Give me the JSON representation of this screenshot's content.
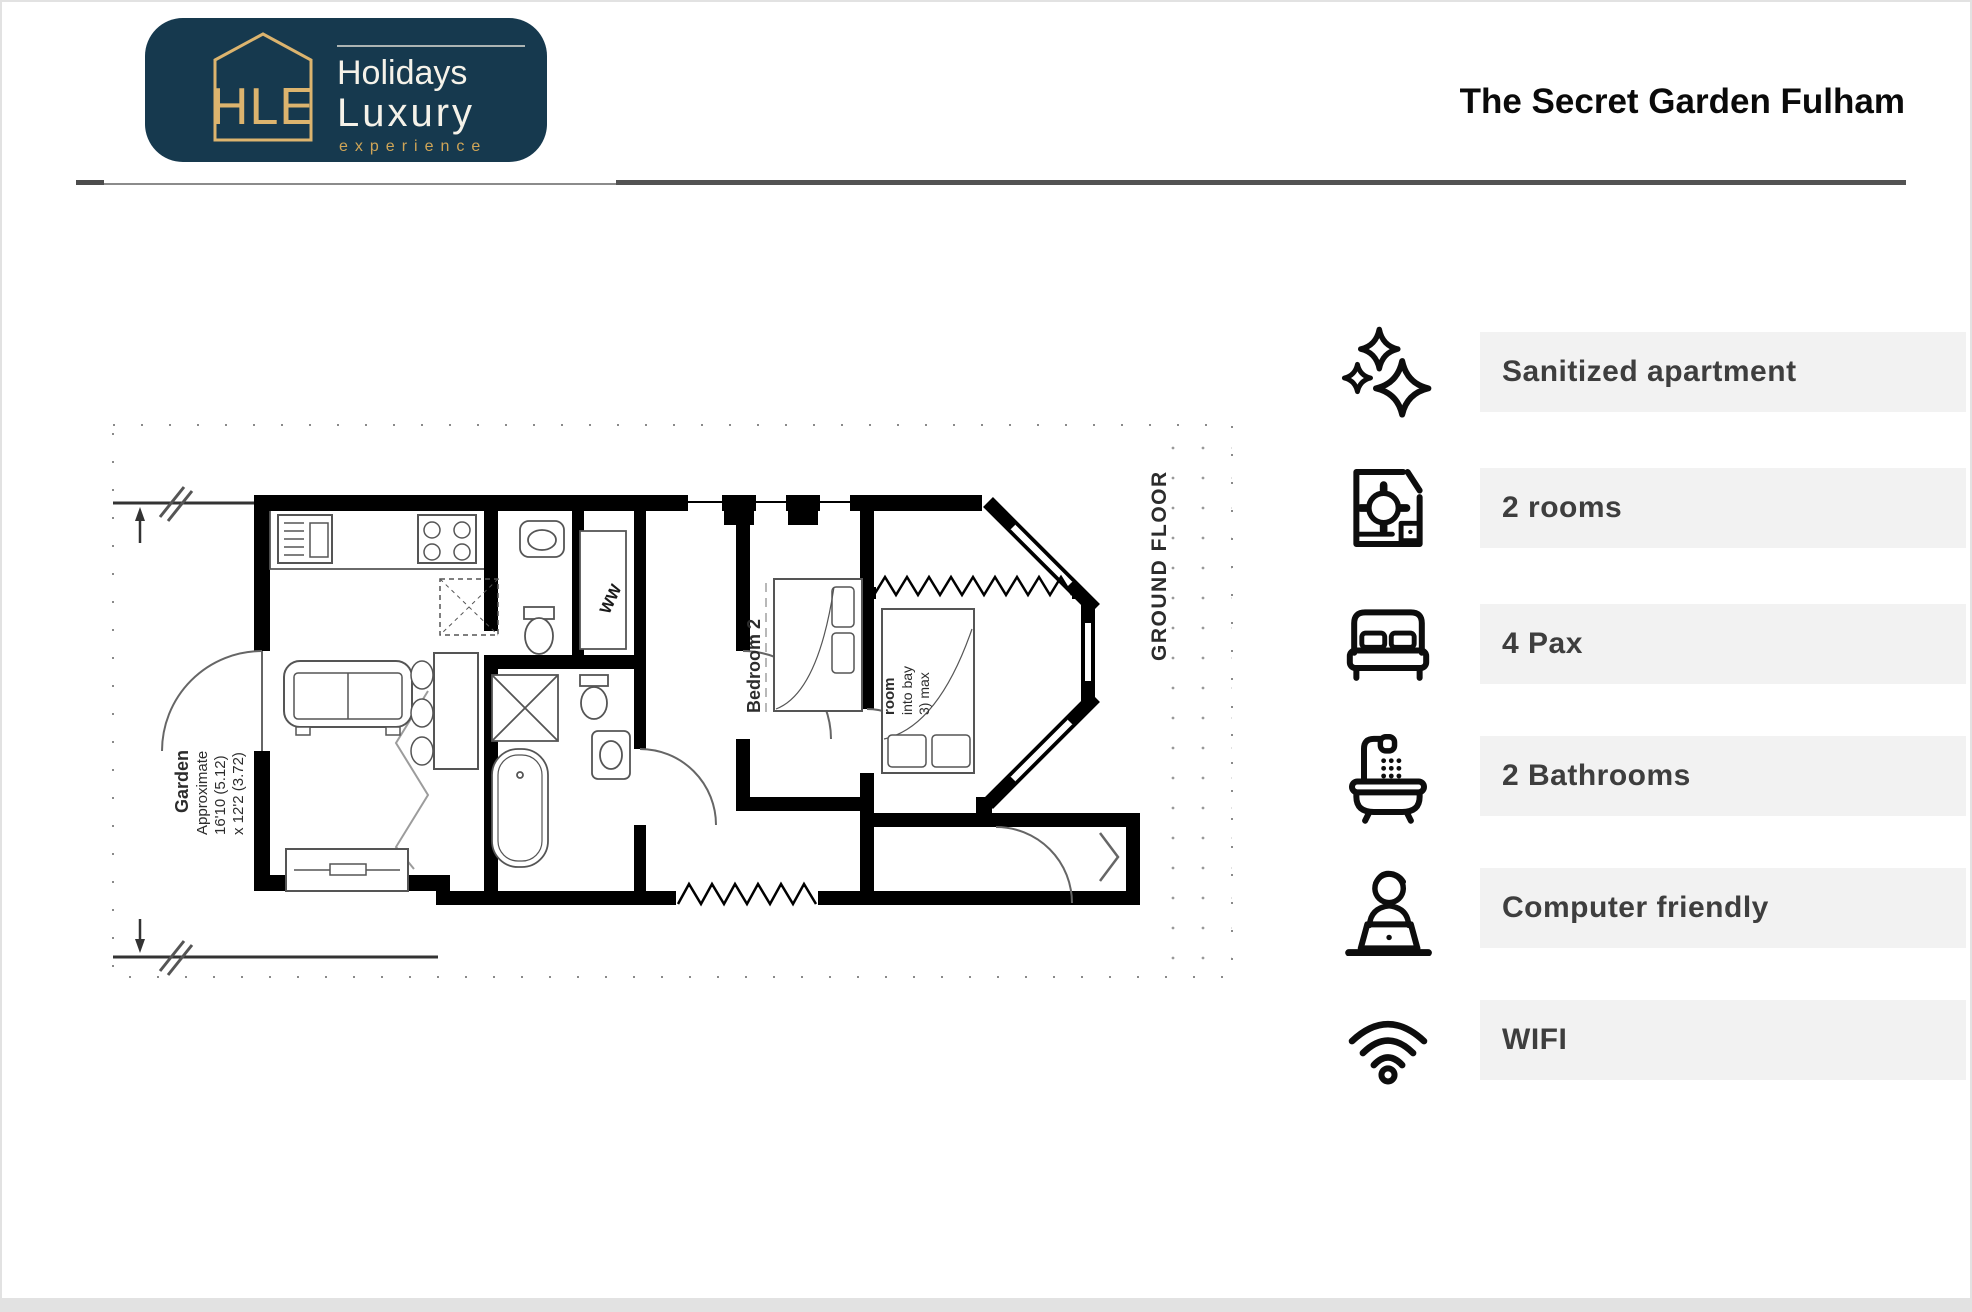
{
  "header": {
    "logo": {
      "monogram": "HLE",
      "brand_line1": "Holidays",
      "brand_line2": "Luxury",
      "tagline": "experience"
    },
    "title": "The Secret Garden Fulham"
  },
  "floor_plan": {
    "garden_label": {
      "line1": "Garden",
      "line2": "Approximate",
      "line3": "16'10 (5.12)",
      "line4": "x 12'2 (3.72)"
    },
    "closet_label": "WW",
    "bedroom2_label": "Bedroom 2",
    "bay_room_label": {
      "line1": "room",
      "line2": "into bay",
      "line3": "3) max"
    },
    "floor_label": "GROUND FLOOR"
  },
  "amenities": {
    "items": [
      {
        "icon": "sparkles-icon",
        "label": "Sanitized apartment"
      },
      {
        "icon": "floorplan-icon",
        "label": "2 rooms"
      },
      {
        "icon": "bed-icon",
        "label": "4 Pax"
      },
      {
        "icon": "bathtub-icon",
        "label": "2 Bathrooms"
      },
      {
        "icon": "person-laptop-icon",
        "label": "Computer friendly"
      },
      {
        "icon": "wifi-icon",
        "label": "WIFI"
      }
    ]
  },
  "colors": {
    "navy": "#16394e",
    "gold": "#dcb46e",
    "gold_dark": "#cfa557",
    "bar_bg": "#f2f2f2",
    "text_dark": "#3e3e3e",
    "rule_gray": "#535353"
  }
}
